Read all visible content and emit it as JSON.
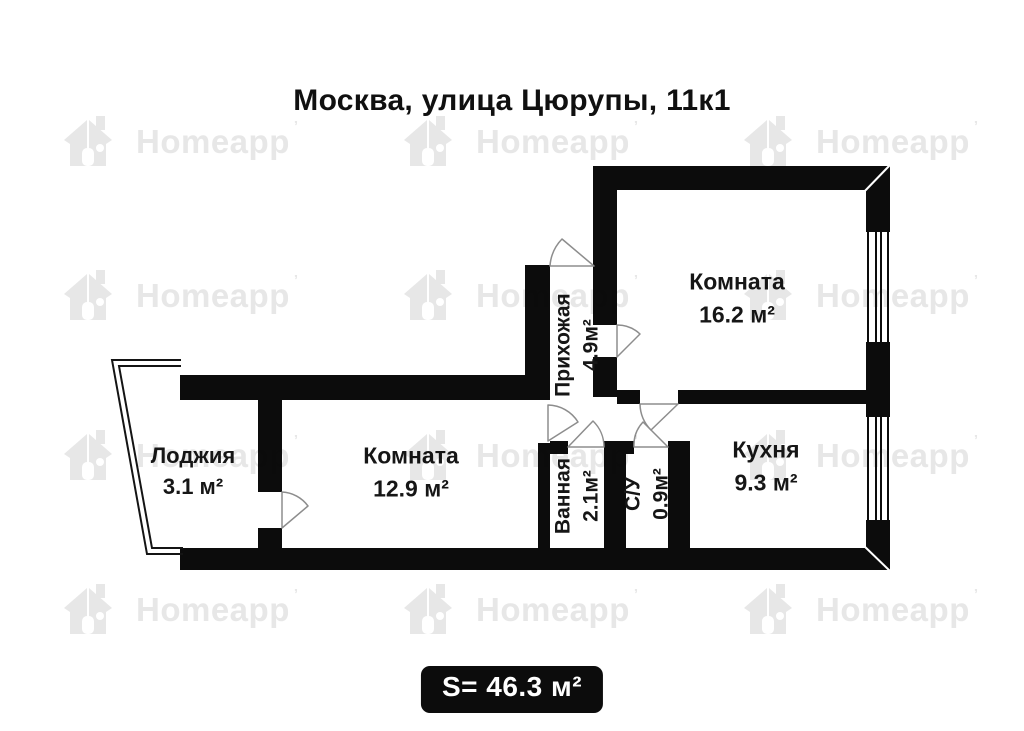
{
  "title": "Москва, улица Цюрупы, 11к1",
  "watermark": {
    "label": "Homeapp",
    "mark": "’"
  },
  "rooms": {
    "room1": {
      "name": "Комната",
      "area": "16.2 м²"
    },
    "room2": {
      "name": "Комната",
      "area": "12.9 м²"
    },
    "loggia": {
      "name": "Лоджия",
      "area": "3.1 м²"
    },
    "kitchen": {
      "name": "Кухня",
      "area": "9.3 м²"
    },
    "hallway": {
      "name": "Прихожая",
      "area": "4.9м²"
    },
    "bathroom": {
      "name": "Ванная",
      "area": "2.1м²"
    },
    "wc": {
      "name": "С/У",
      "area": "0.9м²"
    }
  },
  "total": {
    "label": "S= 46.3 м²"
  },
  "colors": {
    "wall": "#0c0c0c",
    "badge_bg": "#0c0c0c",
    "badge_text": "#ffffff",
    "watermark": "#e7e7e7",
    "door_arc": "#8d8d8d"
  }
}
